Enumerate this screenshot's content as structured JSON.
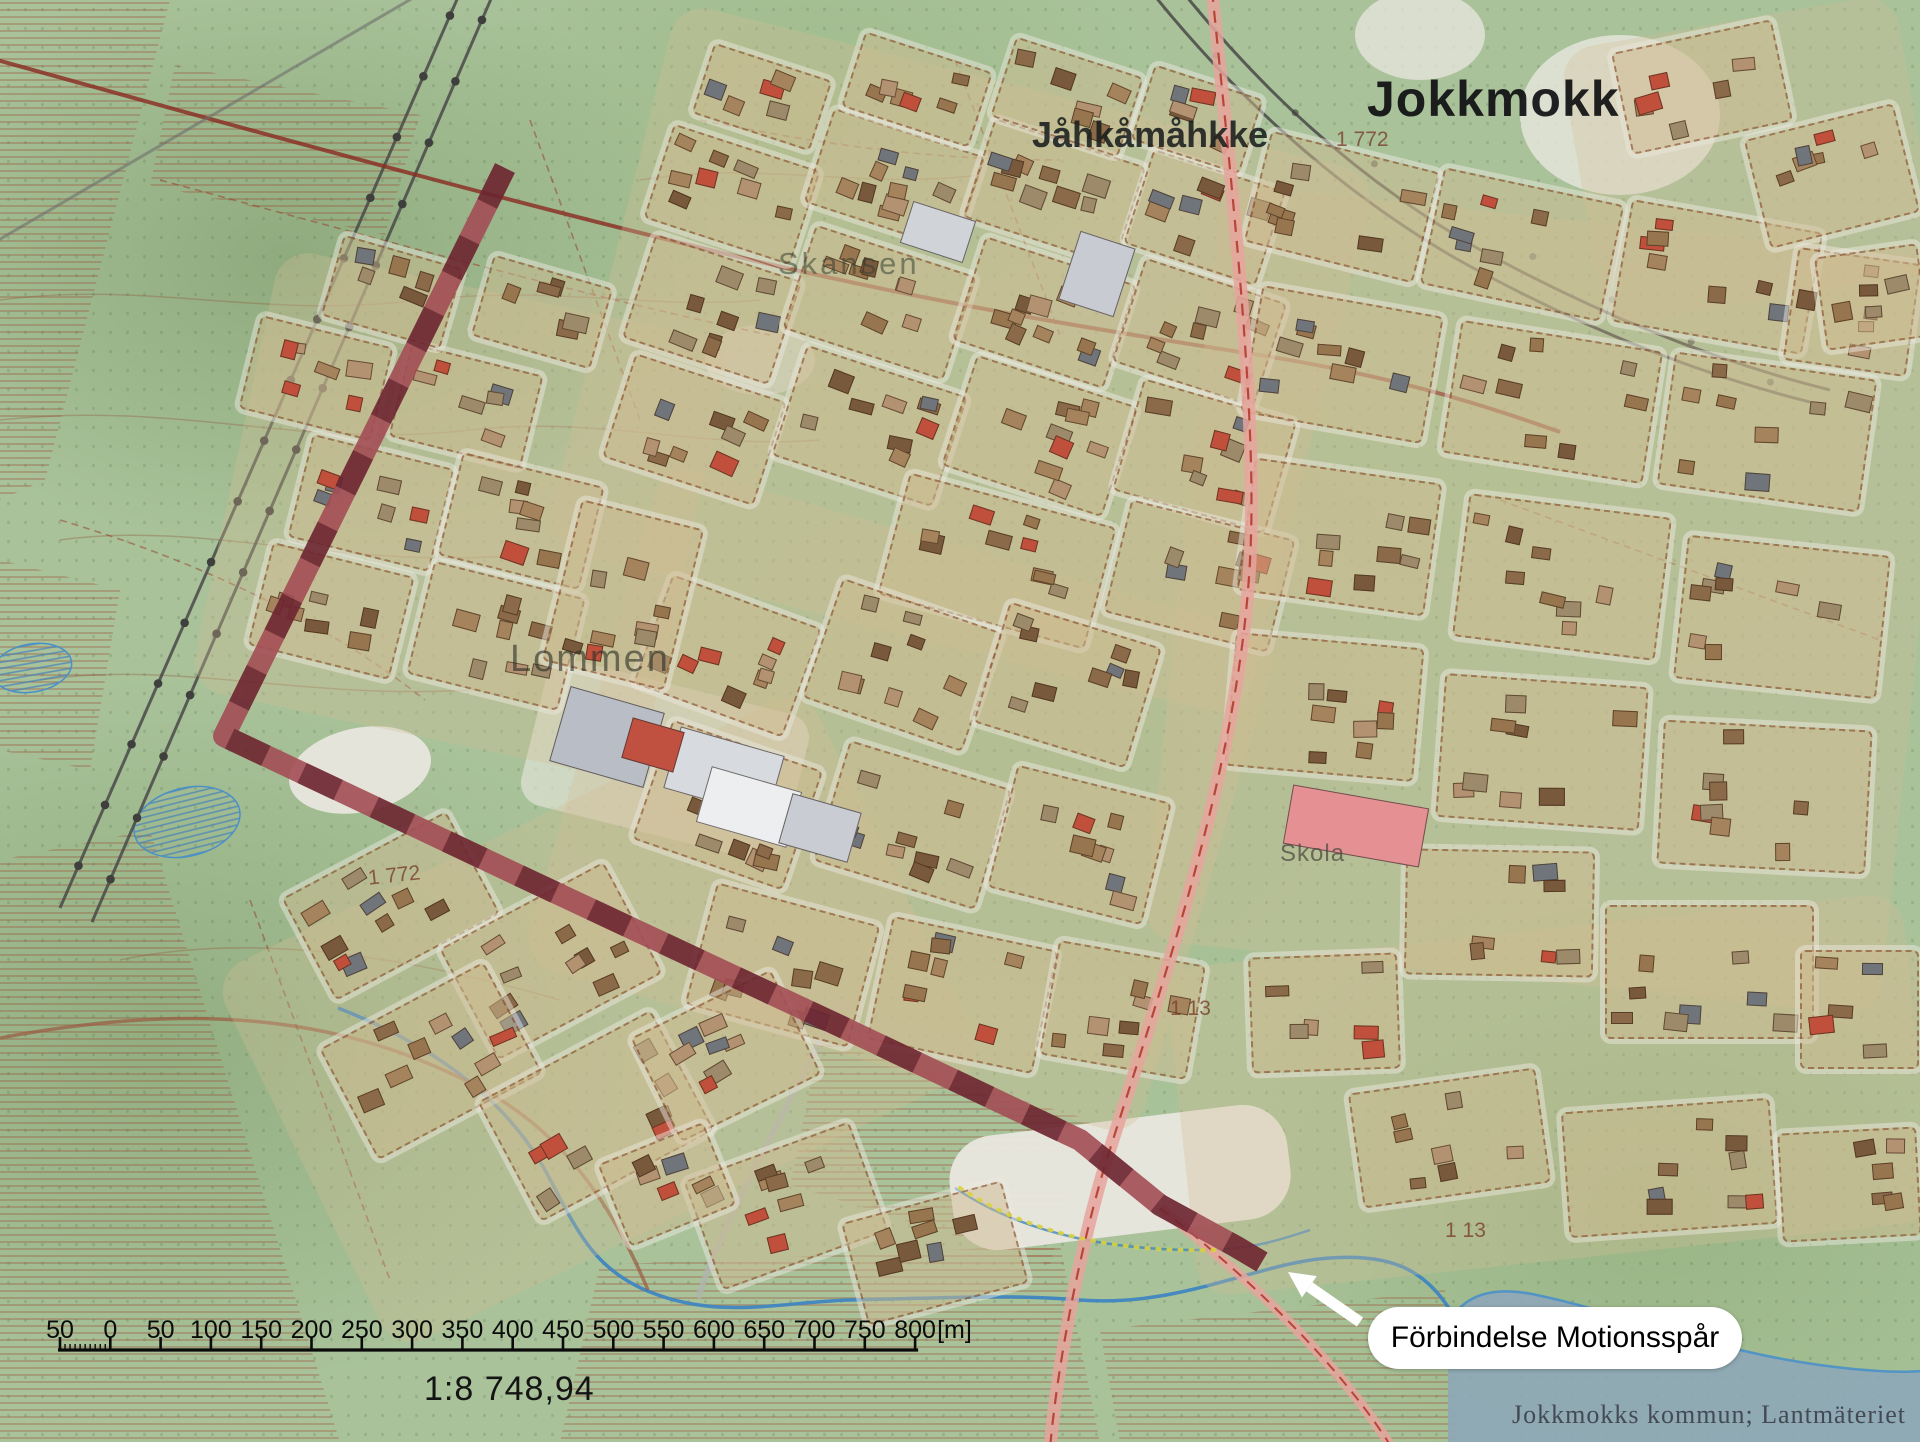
{
  "map": {
    "labels": [
      {
        "id": "jokkmokk",
        "text": "Jokkmokk",
        "x": 1367,
        "y": 70,
        "cls": "lbl-town"
      },
      {
        "id": "jahkamahkke",
        "text": "Jåhkåmåhkke",
        "x": 1032,
        "y": 114,
        "cls": "lbl-town2"
      },
      {
        "id": "skansen",
        "text": "Skansen",
        "x": 778,
        "y": 246,
        "cls": "lbl-area-faint"
      },
      {
        "id": "lommen",
        "text": "Lommen",
        "x": 510,
        "y": 638,
        "cls": "lbl-area"
      },
      {
        "id": "skola",
        "text": "Skola",
        "x": 1280,
        "y": 840,
        "cls": "lbl-small"
      },
      {
        "id": "elev-1772-west",
        "text": "1 772",
        "x": 368,
        "y": 864,
        "cls": "lbl-elev",
        "rot": -6
      },
      {
        "id": "elev-1772-northeast",
        "text": "1 772",
        "x": 1336,
        "y": 128,
        "cls": "lbl-elev"
      },
      {
        "id": "elev-113-a",
        "text": "1 13",
        "x": 1170,
        "y": 997,
        "cls": "lbl-elev"
      },
      {
        "id": "elev-113-b",
        "text": "1 13",
        "x": 1445,
        "y": 1219,
        "cls": "lbl-elev"
      }
    ]
  },
  "scalebar": {
    "tick_labels": [
      "50",
      "0",
      "50",
      "100",
      "150",
      "200",
      "250",
      "300",
      "350",
      "400",
      "450",
      "500",
      "550",
      "600",
      "650",
      "700",
      "750",
      "800"
    ],
    "unit": "[m]",
    "scale_text": "1:8 748,94"
  },
  "callout": {
    "text": "Förbindelse Motionsspår"
  },
  "attribution": "Jokkmokks kommun; Lantmäteriet",
  "trail": {
    "name": "Förbindelse Motionsspår",
    "colors": {
      "dark": "#6d2530",
      "light": "#a34e55"
    },
    "width": 22,
    "dash": 40,
    "points": [
      [
        505,
        168
      ],
      [
        224,
        736
      ],
      [
        520,
        876
      ],
      [
        840,
        1026
      ],
      [
        1080,
        1140
      ],
      [
        1160,
        1205
      ],
      [
        1235,
        1246
      ],
      [
        1262,
        1262
      ]
    ]
  },
  "arrow": {
    "from": [
      1360,
      1322
    ],
    "to": [
      1288,
      1272
    ],
    "color": "#ffffff"
  }
}
